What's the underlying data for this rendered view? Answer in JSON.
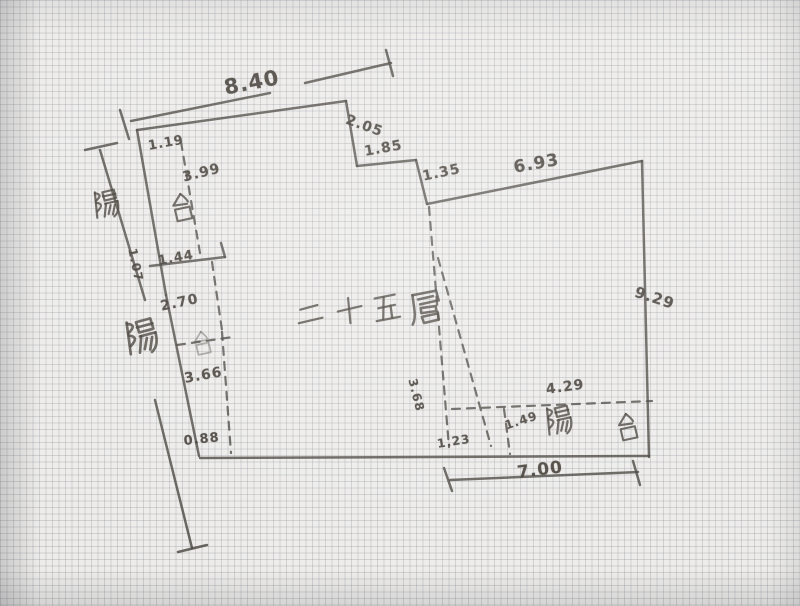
{
  "meta": {
    "description": "hand-drawn apartment floor plan sketch on graph paper",
    "floor_title": "二十五層",
    "balcony_text": "陽台"
  },
  "canvas": {
    "width": 800,
    "height": 606,
    "paper_color": "#edecea",
    "ink_color": "#46423d"
  },
  "plan": {
    "solid_lines": [
      [
        131,
        121,
        270,
        93
      ],
      [
        120,
        110,
        129,
        139
      ],
      [
        305,
        83,
        391,
        63
      ],
      [
        386,
        50,
        393,
        76
      ],
      [
        137,
        130,
        346,
        101
      ],
      [
        346,
        101,
        357,
        166
      ],
      [
        357,
        166,
        416,
        160
      ],
      [
        416,
        160,
        427,
        204
      ],
      [
        427,
        204,
        642,
        161
      ],
      [
        642,
        161,
        649,
        457
      ],
      [
        649,
        456,
        200,
        458
      ],
      [
        137,
        130,
        166,
        295
      ],
      [
        166,
        295,
        199,
        456
      ],
      [
        150,
        266,
        225,
        257
      ],
      [
        225,
        257,
        221,
        243
      ],
      [
        100,
        150,
        145,
        300
      ],
      [
        85,
        150,
        117,
        143
      ],
      [
        155,
        400,
        192,
        548
      ],
      [
        178,
        552,
        207,
        545
      ],
      [
        450,
        480,
        638,
        472
      ],
      [
        444,
        468,
        452,
        491
      ],
      [
        633,
        461,
        640,
        485
      ]
    ],
    "dashed_lines": [
      [
        181,
        142,
        200,
        253
      ],
      [
        212,
        262,
        222,
        330
      ],
      [
        177,
        345,
        233,
        337
      ],
      [
        222,
        332,
        231,
        453
      ],
      [
        429,
        207,
        449,
        447
      ],
      [
        438,
        258,
        491,
        446
      ],
      [
        452,
        409,
        652,
        401
      ],
      [
        504,
        409,
        510,
        454
      ]
    ],
    "dim_labels": [
      {
        "text": "8.40",
        "x": 222,
        "y": 76,
        "rot": -11,
        "size": 21
      },
      {
        "text": "2.05",
        "x": 349,
        "y": 112,
        "rot": 20,
        "size": 14
      },
      {
        "text": "1.85",
        "x": 363,
        "y": 144,
        "rot": -10,
        "size": 14
      },
      {
        "text": "1.35",
        "x": 421,
        "y": 169,
        "rot": -12,
        "size": 14
      },
      {
        "text": "6.93",
        "x": 512,
        "y": 158,
        "rot": -10,
        "size": 17
      },
      {
        "text": "9.29",
        "x": 638,
        "y": 283,
        "rot": 18,
        "size": 15
      },
      {
        "text": "1.19",
        "x": 147,
        "y": 139,
        "rot": -10,
        "size": 13
      },
      {
        "text": "3.99",
        "x": 181,
        "y": 170,
        "rot": -14,
        "size": 14
      },
      {
        "text": "1.07",
        "x": 139,
        "y": 247,
        "rot": 78,
        "size": 12
      },
      {
        "text": "1.44",
        "x": 157,
        "y": 254,
        "rot": -10,
        "size": 13
      },
      {
        "text": "2.70",
        "x": 159,
        "y": 299,
        "rot": -12,
        "size": 14
      },
      {
        "text": "3.66",
        "x": 183,
        "y": 371,
        "rot": -10,
        "size": 14
      },
      {
        "text": "0.88",
        "x": 183,
        "y": 434,
        "rot": -6,
        "size": 13
      },
      {
        "text": "3.68",
        "x": 419,
        "y": 377,
        "rot": 76,
        "size": 12
      },
      {
        "text": "1.23",
        "x": 436,
        "y": 437,
        "rot": -9,
        "size": 12
      },
      {
        "text": "1.49",
        "x": 503,
        "y": 419,
        "rot": -18,
        "size": 12
      },
      {
        "text": "4.29",
        "x": 545,
        "y": 382,
        "rot": -8,
        "size": 14
      },
      {
        "text": "7.00",
        "x": 516,
        "y": 463,
        "rot": -7,
        "size": 17
      }
    ],
    "cjk_labels": [
      {
        "char": "陽",
        "x": 88,
        "y": 190,
        "size": 32,
        "rot": -8,
        "role": "balcony"
      },
      {
        "char": "台",
        "x": 164,
        "y": 193,
        "size": 32,
        "rot": -8,
        "role": "balcony"
      },
      {
        "char": "陽",
        "x": 118,
        "y": 320,
        "size": 40,
        "rot": -10,
        "role": "balcony"
      },
      {
        "char": "台",
        "x": 187,
        "y": 331,
        "size": 27,
        "rot": -8,
        "role": "balcony",
        "faint": true
      },
      {
        "char": "陽",
        "x": 540,
        "y": 406,
        "size": 33,
        "rot": -8,
        "role": "balcony"
      },
      {
        "char": "台",
        "x": 610,
        "y": 413,
        "size": 31,
        "rot": -8,
        "role": "balcony"
      },
      {
        "char": "二",
        "x": 290,
        "y": 300,
        "size": 33,
        "rot": -8,
        "role": "title"
      },
      {
        "char": "十",
        "x": 330,
        "y": 296,
        "size": 33,
        "rot": -8,
        "role": "title"
      },
      {
        "char": "五",
        "x": 366,
        "y": 294,
        "size": 34,
        "rot": -8,
        "role": "title"
      },
      {
        "char": "層",
        "x": 404,
        "y": 290,
        "size": 38,
        "rot": -8,
        "role": "title"
      }
    ],
    "glyph_paths": {
      "陽": [
        "M6 3 L5 27",
        "M6 4 Q14 6 6 11",
        "M6 13 Q14 15 6 21",
        "M13 4 L24 3 L25 11 L14 12 Z",
        "M13 8 L25 7",
        "M14 15 L26 14",
        "M15 15 L12 27",
        "M26 14 Q27 24 21 28",
        "M19 17 L16 25",
        "M23 17 L20 26"
      ],
      "台": [
        "M15 3 L7 13 L20 13",
        "M15 3 Q20 8 21 11",
        "M8 17 L22 16 L23 27 L9 28 Z"
      ],
      "二": [
        "M8 10 L24 8",
        "M5 22 L27 20"
      ],
      "十": [
        "M5 15 L27 13",
        "M16 4 L15 27"
      ],
      "五": [
        "M7 5 L25 4",
        "M15 5 L12 24",
        "M9 14 L24 13",
        "M20 13 L20 24",
        "M6 25 L27 24"
      ],
      "層": [
        "M6 5 L25 4 L26 12",
        "M6 5 L6 16 Q6 24 3 28",
        "M10 9 L22 8",
        "M11 13 L24 12",
        "M11 16 L23 16 L23 20 L11 20 Z",
        "M11 23 L24 22 L24 27 L12 28 Z"
      ]
    }
  }
}
